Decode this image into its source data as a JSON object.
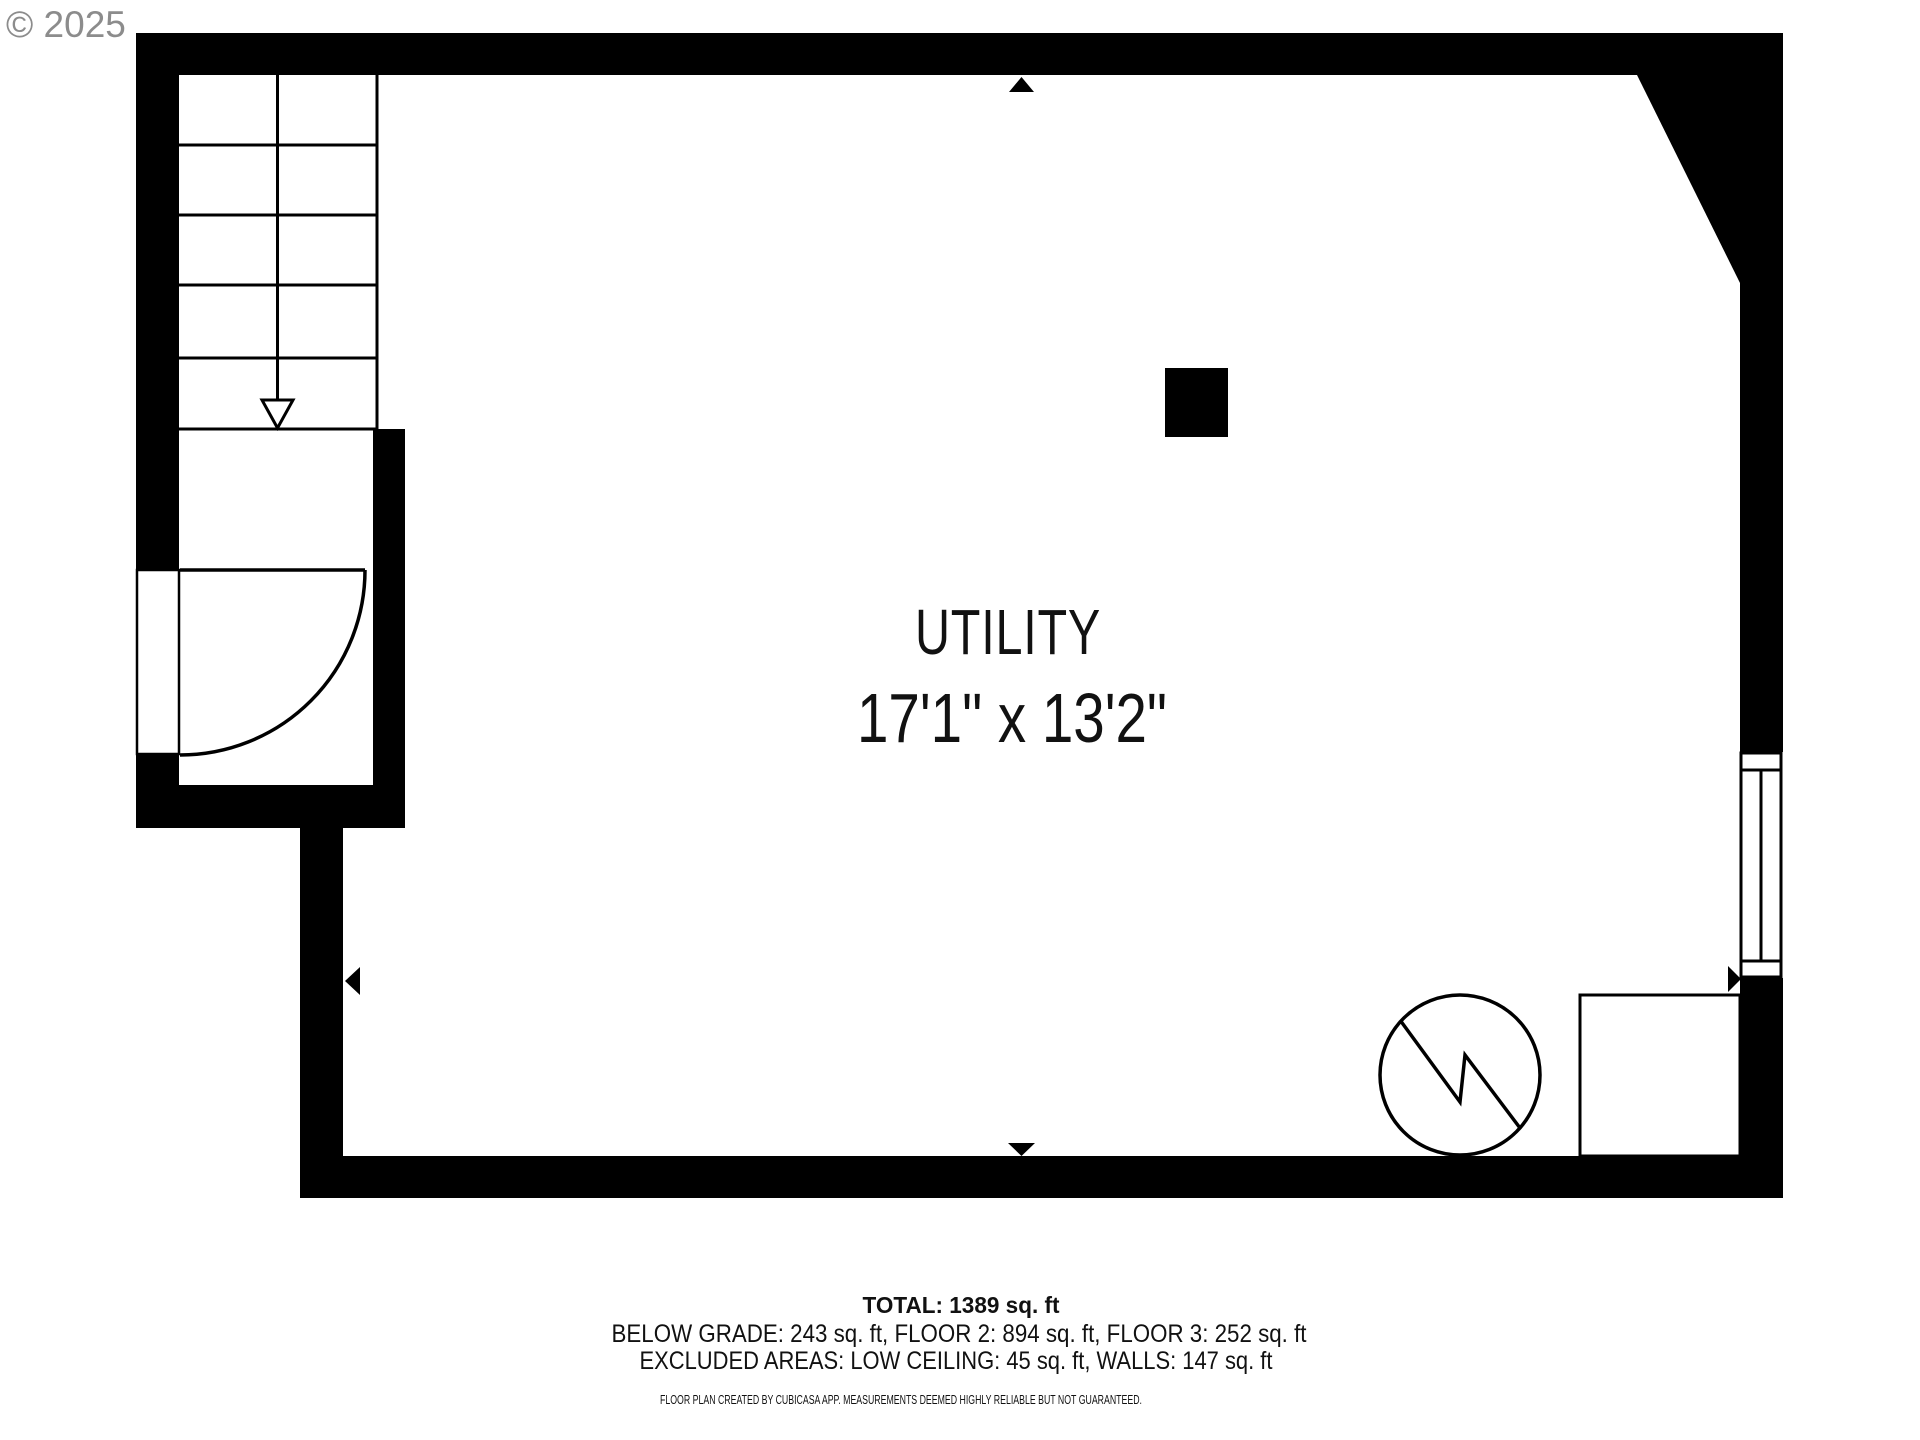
{
  "watermark": {
    "text": "© 2025"
  },
  "plan": {
    "room_label": "UTILITY",
    "room_dimensions": "17'1\" x 13'2\""
  },
  "summary": {
    "total": "TOTAL: 1389 sq. ft",
    "floor_breakdown": "BELOW GRADE: 243 sq. ft, FLOOR 2: 894 sq. ft, FLOOR 3: 252 sq. ft",
    "excluded_areas": "EXCLUDED AREAS: LOW CEILING: 45 sq. ft, WALLS: 147 sq. ft",
    "disclaimer": "FLOOR PLAN CREATED BY CUBICASA APP. MEASUREMENTS DEEMED HIGHLY RELIABLE BUT NOT GUARANTEED."
  },
  "symbols": {
    "staircase": "staircase-down",
    "entry_door": "door-swing-arc",
    "window": "framed-window",
    "pillar": "solid-pillar",
    "water_heater": "circle-zigzag-water-heater",
    "furnace": "appliance-box",
    "dimension_markers": "wall-midpoint-triangles"
  },
  "colors": {
    "walls": "#000000",
    "background": "#ffffff",
    "watermark": "#8c8c8c",
    "text": "#111111"
  }
}
